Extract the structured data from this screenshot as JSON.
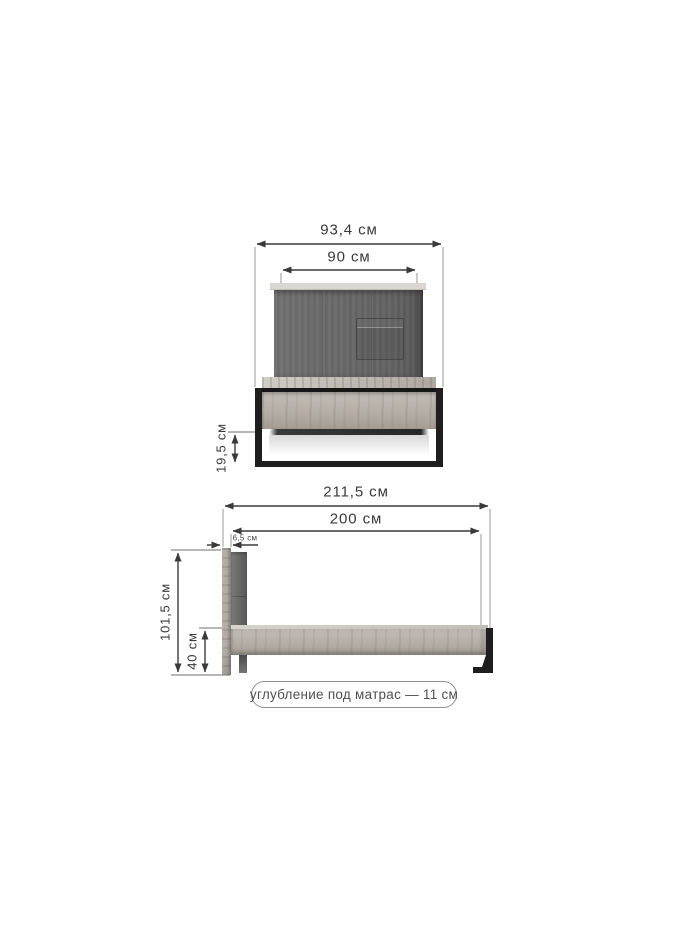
{
  "front_view": {
    "total_width": "93,4 см",
    "headboard_width": "90 см",
    "under_bed_clearance": "19,5 см"
  },
  "side_view": {
    "total_length": "211,5 см",
    "mattress_length": "200 см",
    "headboard_thickness": "6,5 см",
    "total_height": "101,5 см",
    "frame_height": "40 см"
  },
  "note": {
    "mattress_recess": "углубление под матрас — 11 см"
  },
  "colors": {
    "dimension_line": "#3a3a3a",
    "extension_line": "#9a9a9a",
    "fabric_gray": "#686868",
    "wood_light": "#b5b0a8",
    "metal_black": "#1e1e1e",
    "note_border": "#8f8f8f"
  }
}
